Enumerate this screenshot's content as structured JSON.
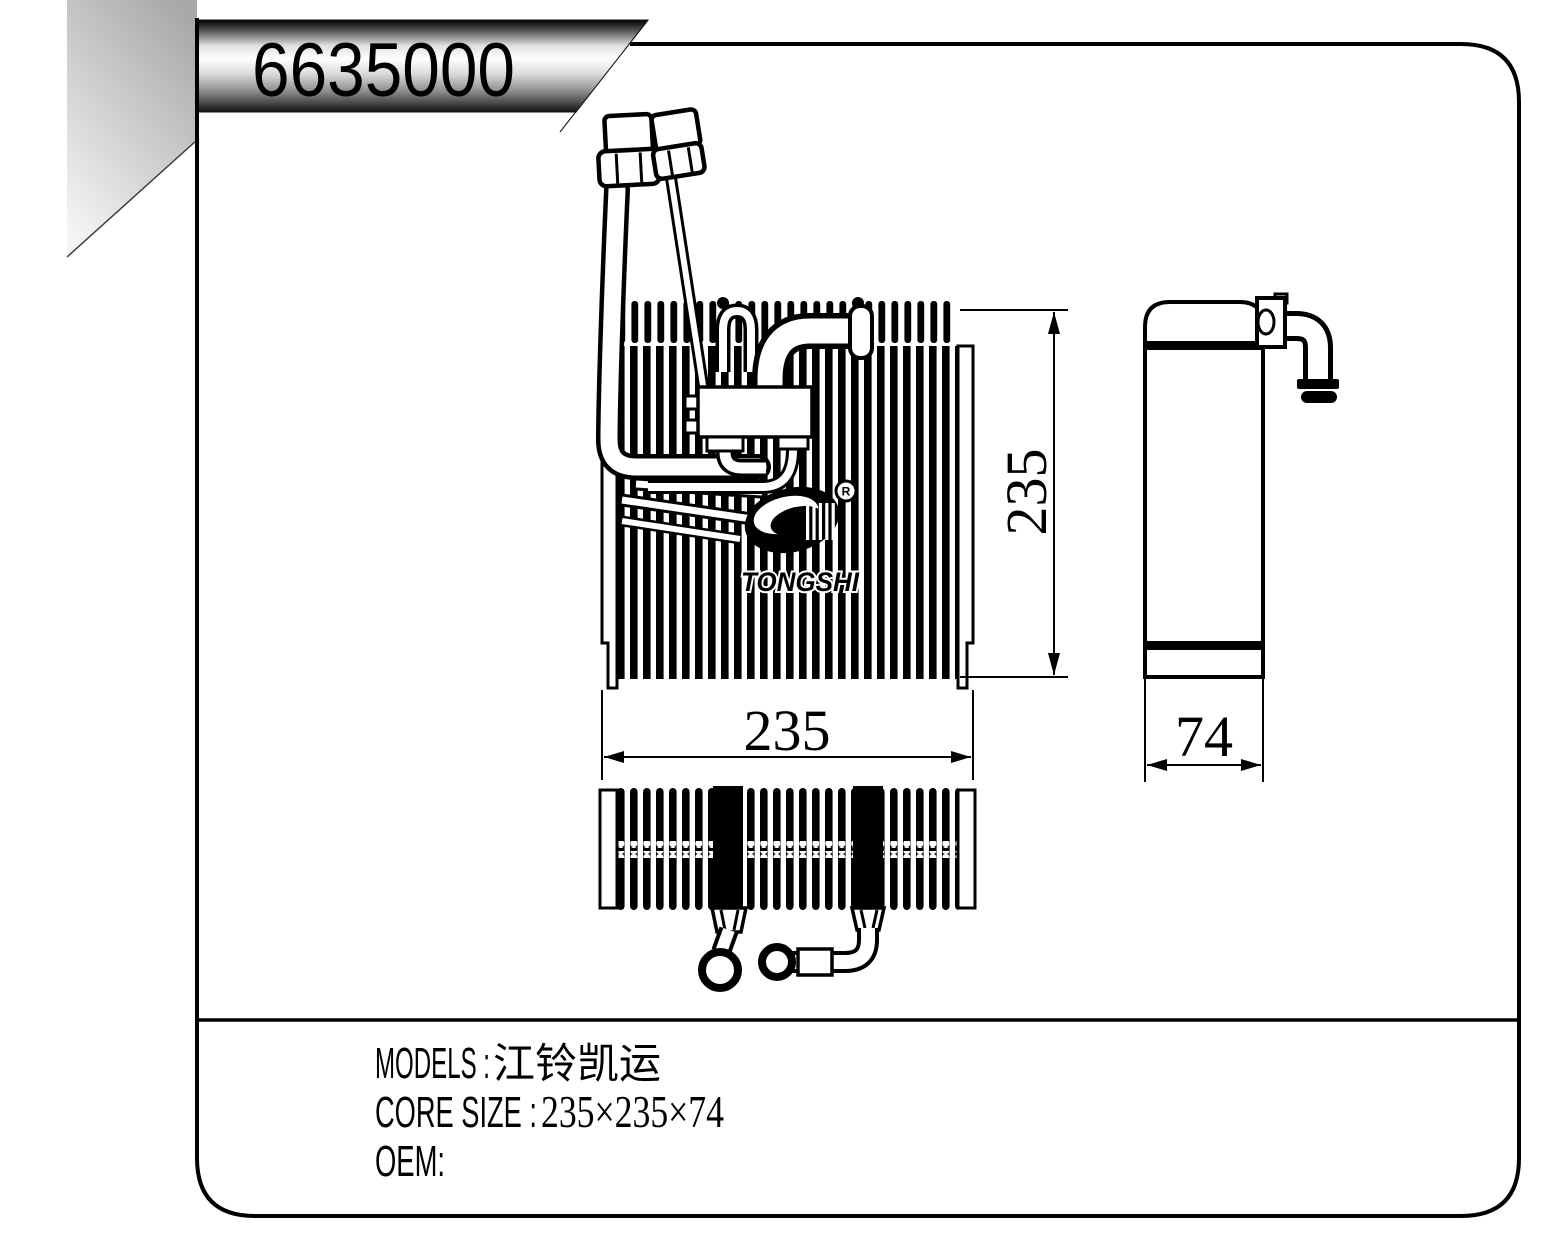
{
  "banner": {
    "part_number": "6635000"
  },
  "dimensions": {
    "front_height": "235",
    "front_width": "235",
    "side_depth": "74"
  },
  "logo": {
    "brand": "TONGSHI",
    "registered_mark": "R"
  },
  "specs": {
    "models_label": "MODELS :",
    "models_value": "江铃凯运",
    "core_size_label": "CORE SIZE :",
    "core_size_value": "235×235×74",
    "oem_label": "OEM:"
  },
  "colors": {
    "line": "#000000",
    "background": "#ffffff",
    "fold_gray": "#a9a9a9",
    "banner_light": "#ffffff",
    "banner_dark": "#141414"
  }
}
